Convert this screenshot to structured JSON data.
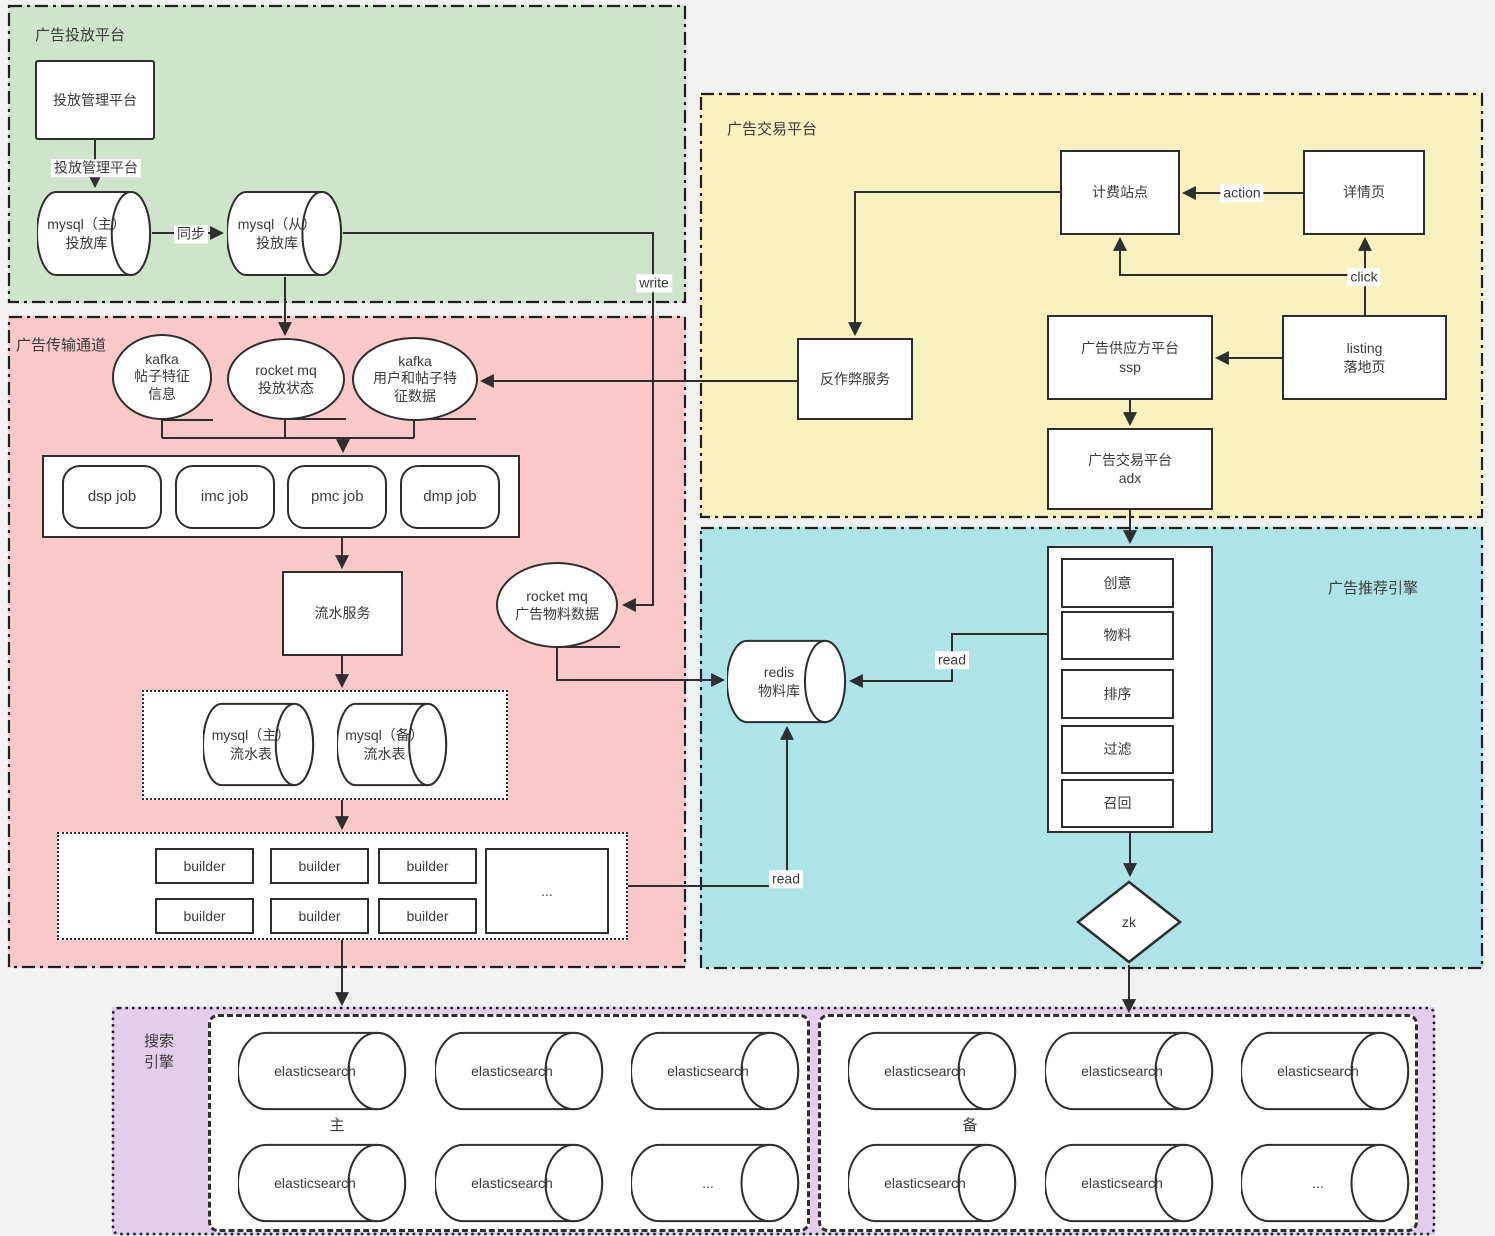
{
  "regions": {
    "ad_delivery": "广告投放平台",
    "ad_channel": "广告传输通道",
    "ad_exchange": "广告交易平台",
    "ad_recommend": "广告推荐引擎",
    "search_engine": "搜索\n引擎"
  },
  "nodes": {
    "mgmt_platform": "投放管理平台",
    "mysql_master_ads": "mysql（主）\n投放库",
    "mysql_slave_ads": "mysql（从）\n投放库",
    "kafka_post_feature": "kafka\n帖子特征\n信息",
    "rocketmq_delivery_status": "rocket mq\n投放状态",
    "kafka_user_post_feature": "kafka\n用户和帖子特\n征数据",
    "jobs": [
      "dsp job",
      "imc job",
      "pmc job",
      "dmp job"
    ],
    "flow_service": "流水服务",
    "rocketmq_ad_material": "rocket mq\n广告物料数据",
    "mysql_master_flow": "mysql（主）\n流水表",
    "mysql_backup_flow": "mysql（备）\n流水表",
    "builder": "builder",
    "ellipsis": "...",
    "billing_site": "计费站点",
    "detail_page": "详情页",
    "anti_fraud": "反作弊服务",
    "ssp": "广告供应方平台\nssp",
    "listing_page": "listing\n落地页",
    "adx": "广告交易平台\nadx",
    "redis_material": "redis\n物料库",
    "stack": [
      "创意",
      "物料",
      "排序",
      "过滤",
      "召回"
    ],
    "zk": "zk",
    "elasticsearch": "elasticsearch",
    "es_main_label": "主",
    "es_backup_label": "备"
  },
  "edge_labels": {
    "mgmt": "投放管理平台",
    "sync": "同步",
    "write": "write",
    "action": "action",
    "click": "click",
    "read_stack": "read",
    "read_builder": "read"
  },
  "colors": {
    "delivery_region": "#cfe5cb",
    "channel_region": "#fbc9c9",
    "exchange_region": "#f8f2c1",
    "recommend_region": "#aee4e8",
    "search_region": "#e3cdec",
    "stroke": "#2e2e2e"
  }
}
